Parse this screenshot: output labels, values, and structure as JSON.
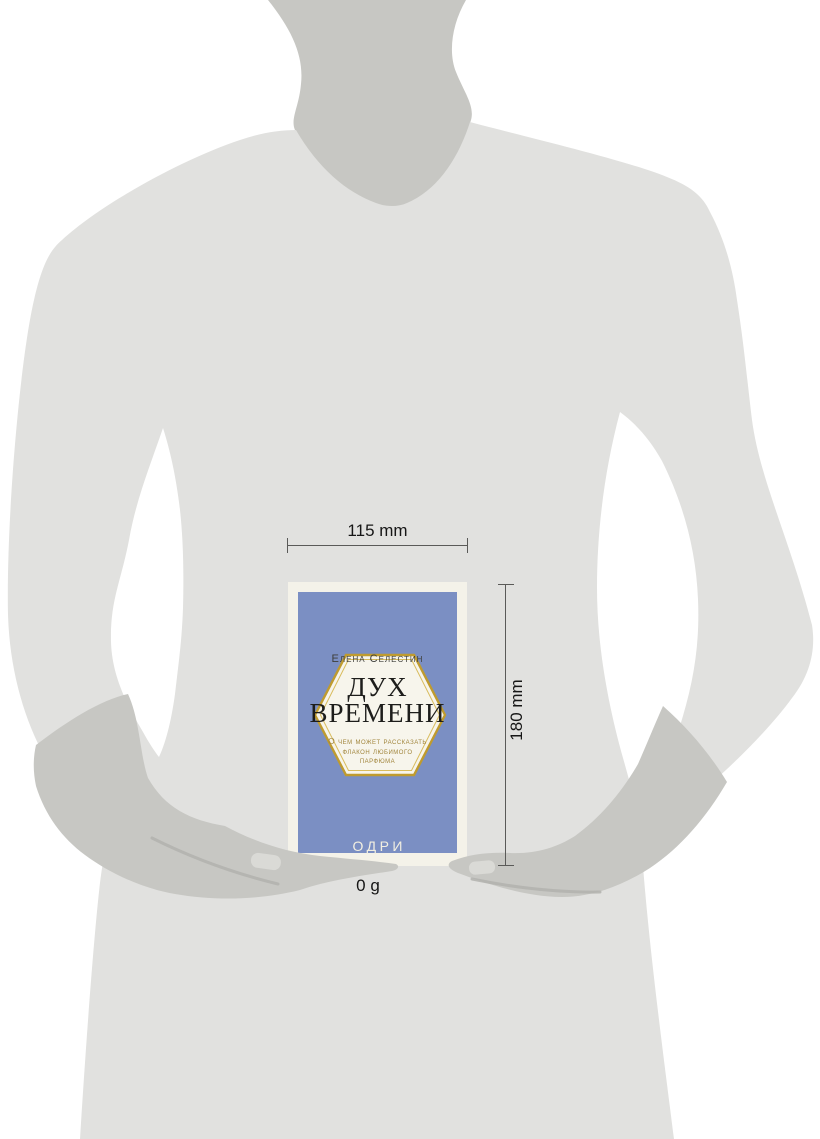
{
  "annotations": {
    "width_label": "115 mm",
    "height_label": "180 mm",
    "weight_label": "0 g"
  },
  "book": {
    "author": "Елена Селестин",
    "title_line1": "ДУХ",
    "title_line2": "ВРЕМЕНИ",
    "subtitle_line1": "О чем может рассказать",
    "subtitle_line2": "флакон любимого",
    "subtitle_line3": "парфюма",
    "publisher": "ОДРИ"
  },
  "theme": {
    "background": "#ffffff",
    "body_color": "#e1e1df",
    "skin_color": "#c7c7c3",
    "crease_color": "#b2b2ae",
    "nail_color": "#dadad6",
    "cover_blue": "#7b8fc3",
    "cover_border": "#f4f2e9",
    "hexagon_fill": "#f7f5ec",
    "hexagon_gold": "#bf9b2f",
    "hexagon_gold_light": "#d9bc5e",
    "subtitle_gold": "#a1853c",
    "title_ink": "#1d1d1b",
    "author_ink": "#3e3e3a",
    "publisher_text": "#f2efe1",
    "anno_ink": "#161616",
    "anno_line": "#5a5a58"
  }
}
